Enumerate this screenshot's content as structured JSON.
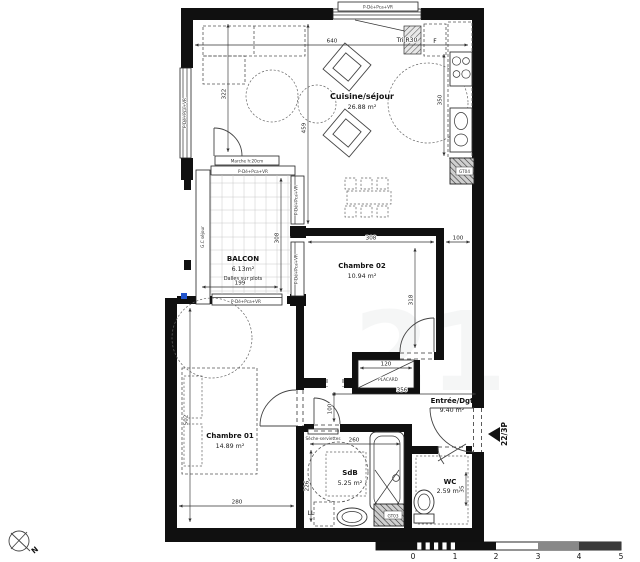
{
  "rooms": {
    "cuisine": {
      "name": "Cuisine/séjour",
      "area": "26.88 m²"
    },
    "balcon": {
      "name": "BALCON",
      "area": "6.13m²",
      "note": "Dalles sur plots"
    },
    "chambre02": {
      "name": "Chambre 02",
      "area": "10.94 m²"
    },
    "chambre01": {
      "name": "Chambre 01",
      "area": "14.89 m²"
    },
    "entree": {
      "name": "Entrée/Dgt",
      "area": "9.40 m²"
    },
    "sdb": {
      "name": "SdB",
      "area": "5.25 m²"
    },
    "wc": {
      "name": "WC",
      "area": "2.59 m²"
    }
  },
  "labels": {
    "unit": "22/3P",
    "north": "N",
    "tri": "Tri R30",
    "fridge": "F",
    "gt04": "GT04",
    "gt03": "GT03",
    "washer": "LL",
    "placard": "PLACARD",
    "step": "Marche h:20cm",
    "window": "P-Dé+Pca+VR",
    "towel_dryer": "Sèche-serviettes",
    "gc_column": "G.C séjour",
    "watermark": "21"
  },
  "dimensions": {
    "sejour_width": "640",
    "sejour_left_h": "322",
    "sejour_mid_h": "459",
    "kitchen_h": "350",
    "ch02_w": "308",
    "ch02_offset": "100",
    "ch02_h": "318",
    "balcon_h": "308",
    "balcon_w": "199",
    "placard_w": "120",
    "entree_w": "356",
    "hall_h": "100",
    "sdb_w": "260",
    "sdb_h": "226",
    "ch01_w": "280",
    "ch01_h": "502",
    "wc_d": "35"
  },
  "scale_bar": {
    "t0": "0",
    "t1": "1",
    "t2": "2",
    "t3": "3",
    "t4": "4",
    "t5": "5"
  }
}
